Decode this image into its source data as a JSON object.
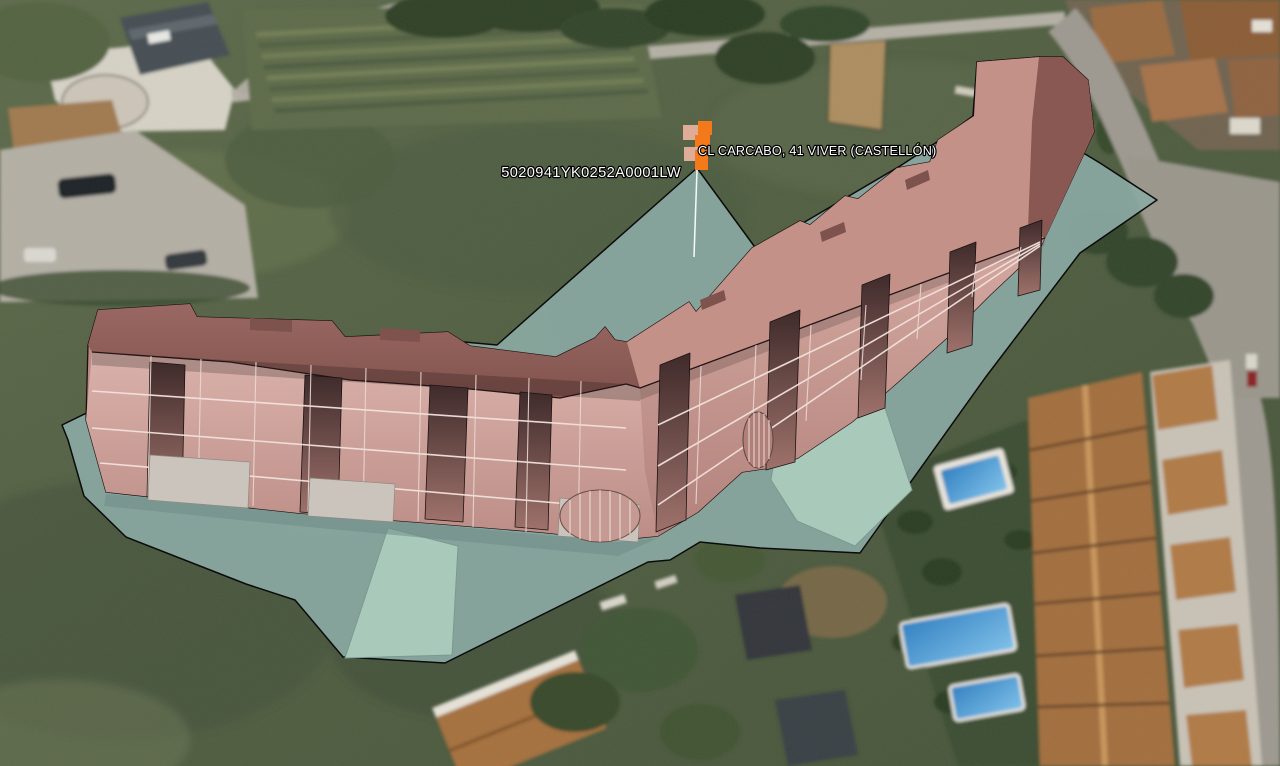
{
  "labels": {
    "address": "CL CARCABO, 41  VIVER (CASTELLÓN)",
    "cadastral_reference": "5020941YK0252A0001LW"
  },
  "marker": {
    "icon": "pixel-flag-marker",
    "primary_color": "#F4791B",
    "secondary_color": "#DFAD97",
    "leader_line_color": "#FFFFFF"
  },
  "colors": {
    "parcel_fill": "#8BA9A3",
    "parcel_subparcel_fill": "#A9CABB",
    "parcel_outline": "#0B0B0B",
    "building_roof": "#8E5E59",
    "building_facade": "#C3948D",
    "building_recess_dark": "#4F3534",
    "building_floor_lines": "#F2E2DD",
    "building_base_blocks": "#CBC4BC",
    "label_text": "#FFFFFF"
  }
}
